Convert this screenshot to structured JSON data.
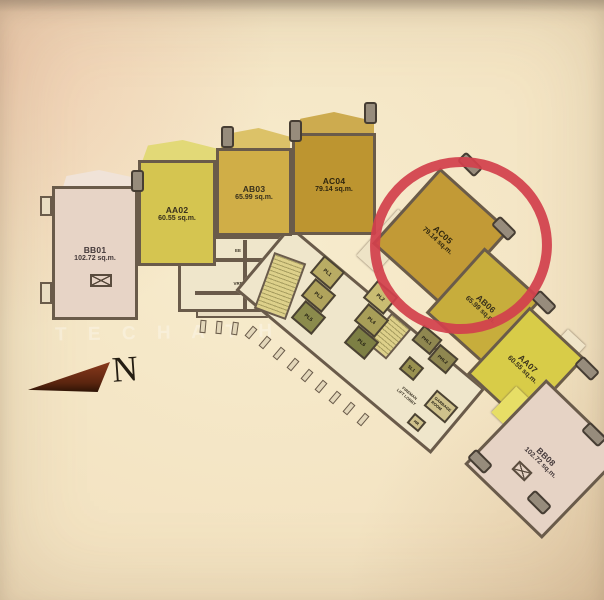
{
  "units": [
    {
      "id": "BB01",
      "area": "102.72 sq.m."
    },
    {
      "id": "AA02",
      "area": "60.55 sq.m."
    },
    {
      "id": "AB03",
      "area": "65.99 sq.m."
    },
    {
      "id": "AC04",
      "area": "79.14 sq.m."
    },
    {
      "id": "AC05",
      "area": "79.14 sq.m."
    },
    {
      "id": "AB06",
      "area": "65.99 sq.m."
    },
    {
      "id": "AA07",
      "area": "60.55 sq.m."
    },
    {
      "id": "BB08",
      "area": "102.72 sq.m."
    }
  ],
  "core": {
    "lifts": [
      "PL1",
      "PL2",
      "PL3",
      "PL4",
      "PL5",
      "PL6"
    ],
    "private_lift_1": "PHL1",
    "private_lift_2": "PHL2",
    "service_lift": "SL1",
    "room_ee": "EE",
    "room_vrf": "VRF",
    "fireman_lobby": "FIREMAN\nLIFT LOBBY",
    "garbage_room": "GARBAGE\nROOM",
    "room_hr": "HR"
  },
  "compass": {
    "label": "N"
  },
  "watermark": "T E C H A T H O N S  H O M E",
  "highlight": {
    "unit": "AC05",
    "color": "#d2414c"
  }
}
